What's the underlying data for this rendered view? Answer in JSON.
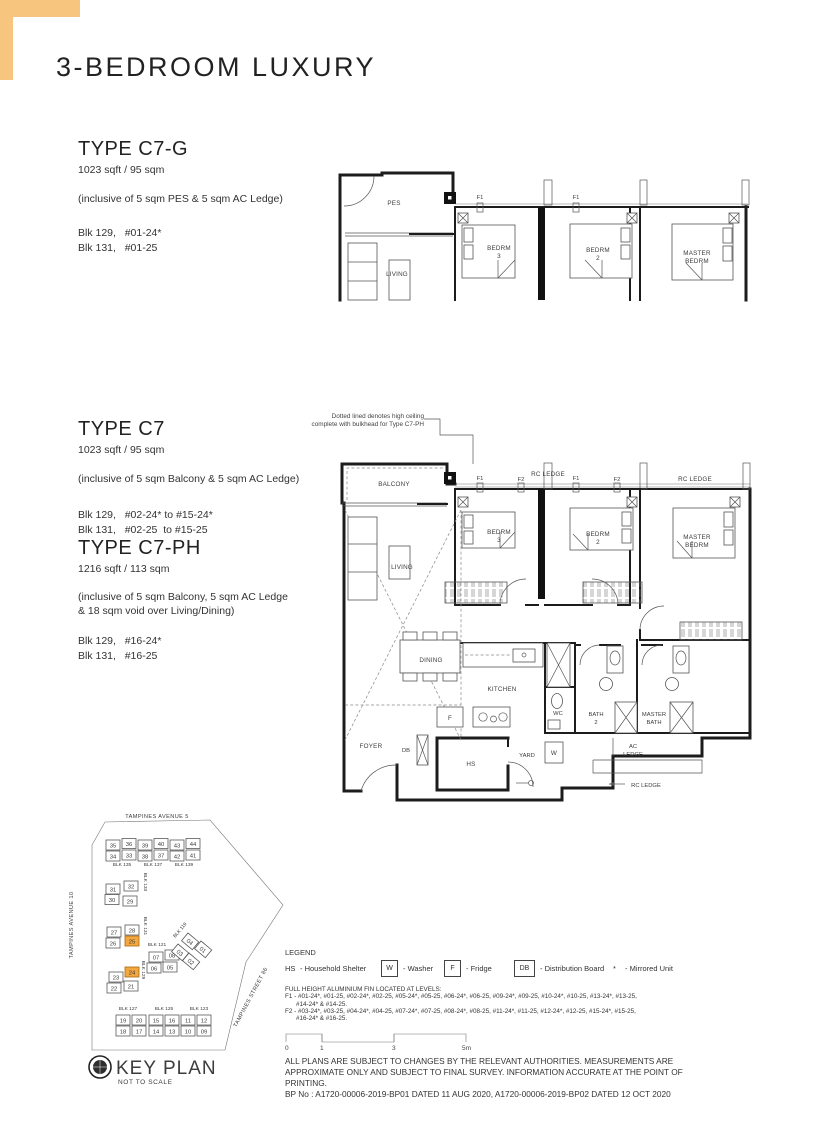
{
  "accent": {
    "corner": "#F8C57E",
    "highlight": "#F2A73F"
  },
  "header": {
    "title": "3-BEDROOM LUXURY"
  },
  "type_c7g": {
    "name": "TYPE C7-G",
    "area": "1023 sqft / 95 sqm",
    "inclusive": "(inclusive of 5 sqm PES & 5 sqm AC Ledge)",
    "blk1": "Blk 129,   #01-24*",
    "blk2": "Blk 131,   #01-25"
  },
  "type_c7": {
    "name": "TYPE C7",
    "area": "1023 sqft / 95 sqm",
    "inclusive": "(inclusive of 5 sqm Balcony & 5 sqm AC Ledge)",
    "blk1": "Blk 129,   #02-24* to #15-24*",
    "blk2": "Blk 131,   #02-25  to #15-25"
  },
  "type_c7ph": {
    "name": "TYPE C7-PH",
    "area": "1216 sqft / 113 sqm",
    "inclusive1": "(inclusive of 5 sqm Balcony, 5 sqm AC Ledge",
    "inclusive2": "& 18 sqm void over Living/Dining)",
    "blk1": "Blk 129,   #16-24*",
    "blk2": "Blk 131,   #16-25"
  },
  "plan_note": {
    "line1": "Dotted lined denotes high ceiling",
    "line2": "complete with bulkhead for Type C7-PH"
  },
  "plan_c7g": {
    "pes": "PES",
    "living": "LIVING",
    "f1": "F1",
    "bedrm3_l1": "BEDRM",
    "bedrm3_l2": "3",
    "bedrm2_l1": "BEDRM",
    "bedrm2_l2": "2",
    "master_l1": "MASTER",
    "master_l2": "BEDRM"
  },
  "plan_c7": {
    "balcony": "BALCONY",
    "rc_ledge": "RC LEDGE",
    "f1": "F1",
    "f2": "F2",
    "bedrm3_l1": "BEDRM",
    "bedrm3_l2": "3",
    "bedrm2_l1": "BEDRM",
    "bedrm2_l2": "2",
    "master_l1": "MASTER",
    "master_l2": "BEDRM",
    "living": "LIVING",
    "dining": "DINING",
    "kitchen": "KITCHEN",
    "fridge": "F",
    "wc": "WC",
    "bath2_l1": "BATH",
    "bath2_l2": "2",
    "mbath_l1": "MASTER",
    "mbath_l2": "BATH",
    "acledge_l1": "AC",
    "acledge_l2": "LEDGE",
    "rc_ledge_bottom": "RC LEDGE",
    "foyer": "FOYER",
    "db": "DB",
    "hs": "HS",
    "yard": "YARD",
    "washer": "W"
  },
  "key_plan": {
    "title": "KEY PLAN",
    "subtitle": "NOT TO SCALE",
    "street_top": "TAMPINES AVENUE 5",
    "street_left": "TAMPINES AVENUE 10",
    "street_right": "TAMPINES STREET 86",
    "units": [
      {
        "n": "35",
        "x": 46,
        "y": 40
      },
      {
        "n": "36",
        "x": 62,
        "y": 38.5
      },
      {
        "n": "39",
        "x": 78,
        "y": 40
      },
      {
        "n": "40",
        "x": 94,
        "y": 38.5
      },
      {
        "n": "43",
        "x": 110,
        "y": 40
      },
      {
        "n": "44",
        "x": 126,
        "y": 38.5
      },
      {
        "n": "34",
        "x": 46,
        "y": 51
      },
      {
        "n": "33",
        "x": 62,
        "y": 50
      },
      {
        "n": "38",
        "x": 78,
        "y": 51
      },
      {
        "n": "37",
        "x": 94,
        "y": 50
      },
      {
        "n": "42",
        "x": 110,
        "y": 51
      },
      {
        "n": "41",
        "x": 126,
        "y": 50
      },
      {
        "n": "31",
        "x": 46,
        "y": 84
      },
      {
        "n": "32",
        "x": 64,
        "y": 81
      },
      {
        "n": "30",
        "x": 45,
        "y": 94.5
      },
      {
        "n": "29",
        "x": 63,
        "y": 96
      },
      {
        "n": "27",
        "x": 47,
        "y": 127
      },
      {
        "n": "28",
        "x": 65,
        "y": 125
      },
      {
        "n": "26",
        "x": 46,
        "y": 138
      },
      {
        "n": "25",
        "x": 65,
        "y": 136,
        "hl": true
      },
      {
        "n": "23",
        "x": 49,
        "y": 172
      },
      {
        "n": "24",
        "x": 65,
        "y": 167,
        "hl": true
      },
      {
        "n": "22",
        "x": 47,
        "y": 183
      },
      {
        "n": "21",
        "x": 64,
        "y": 181
      },
      {
        "n": "07",
        "x": 89,
        "y": 152
      },
      {
        "n": "08",
        "x": 105,
        "y": 150
      },
      {
        "n": "06",
        "x": 87,
        "y": 163
      },
      {
        "n": "05",
        "x": 103,
        "y": 162
      },
      {
        "n": "04",
        "x": 128,
        "y": 133,
        "r": 40
      },
      {
        "n": "01",
        "x": 141,
        "y": 141,
        "r": 40
      },
      {
        "n": "03",
        "x": 118,
        "y": 144,
        "r": 40
      },
      {
        "n": "02",
        "x": 129,
        "y": 153,
        "r": 40
      },
      {
        "n": "19",
        "x": 56,
        "y": 215
      },
      {
        "n": "20",
        "x": 72,
        "y": 215
      },
      {
        "n": "15",
        "x": 89,
        "y": 215
      },
      {
        "n": "16",
        "x": 105,
        "y": 215
      },
      {
        "n": "11",
        "x": 121,
        "y": 215
      },
      {
        "n": "12",
        "x": 137,
        "y": 215
      },
      {
        "n": "18",
        "x": 56,
        "y": 226
      },
      {
        "n": "17",
        "x": 72,
        "y": 226
      },
      {
        "n": "14",
        "x": 89,
        "y": 226
      },
      {
        "n": "13",
        "x": 105,
        "y": 226
      },
      {
        "n": "10",
        "x": 121,
        "y": 226
      },
      {
        "n": "09",
        "x": 137,
        "y": 226
      }
    ],
    "blocks": [
      {
        "label": "BLK 135",
        "x": 62,
        "y": 66
      },
      {
        "label": "BLK 137",
        "x": 93,
        "y": 66
      },
      {
        "label": "BLK 139",
        "x": 124,
        "y": 66
      },
      {
        "label": "BLK 133",
        "x": 84,
        "y": 82,
        "r": 90
      },
      {
        "label": "BLK 131",
        "x": 84,
        "y": 126,
        "r": 90
      },
      {
        "label": "BLK 129",
        "x": 82,
        "y": 170,
        "r": 90
      },
      {
        "label": "BLK 121",
        "x": 97,
        "y": 146
      },
      {
        "label": "BLK 119",
        "x": 121,
        "y": 131,
        "r": -50
      },
      {
        "label": "BLK 127",
        "x": 68,
        "y": 210
      },
      {
        "label": "BLK 125",
        "x": 104,
        "y": 210
      },
      {
        "label": "BLK 123",
        "x": 139,
        "y": 210
      }
    ]
  },
  "legend": {
    "title": "LEGEND",
    "items": [
      {
        "key": "HS",
        "label": "- Household Shelter",
        "boxed": false
      },
      {
        "key": "W",
        "label": "- Washer",
        "boxed": true
      },
      {
        "key": "F",
        "label": "- Fridge",
        "boxed": true
      },
      {
        "key": "DB",
        "label": "- Distribution Board",
        "boxed": true
      },
      {
        "key": "*",
        "label": "- Mirrored Unit",
        "boxed": false
      }
    ]
  },
  "fin_note": {
    "title": "FULL HEIGHT ALUMINIUM FIN LOCATED AT LEVELS:",
    "f1a": "F1 - #01-24*, #01-25, #02-24*, #02-25, #05-24*, #05-25, #06-24*, #06-25, #09-24*, #09-25, #10-24*, #10-25, #13-24*, #13-25,",
    "f1b": "#14-24* & #14-25.",
    "f2a": "F2 - #03-24*, #03-25, #04-24*, #04-25, #07-24*, #07-25, #08-24*, #08-25, #11-24*, #11-25, #12-24*, #12-25, #15-24*, #15-25,",
    "f2b": "#16-24* & #16-25."
  },
  "scale_bar": {
    "ticks": [
      "0",
      "1",
      "3",
      "5m"
    ]
  },
  "disclaimer": {
    "d1": "ALL PLANS ARE SUBJECT TO CHANGES BY THE RELEVANT AUTHORITIES. MEASUREMENTS ARE",
    "d2": "APPROXIMATE ONLY AND SUBJECT TO FINAL SURVEY. INFORMATION ACCURATE AT THE POINT OF PRINTING.",
    "d3": "BP No : A1720-00006-2019-BP01 DATED 11 AUG 2020, A1720-00006-2019-BP02 DATED 12 OCT 2020"
  }
}
